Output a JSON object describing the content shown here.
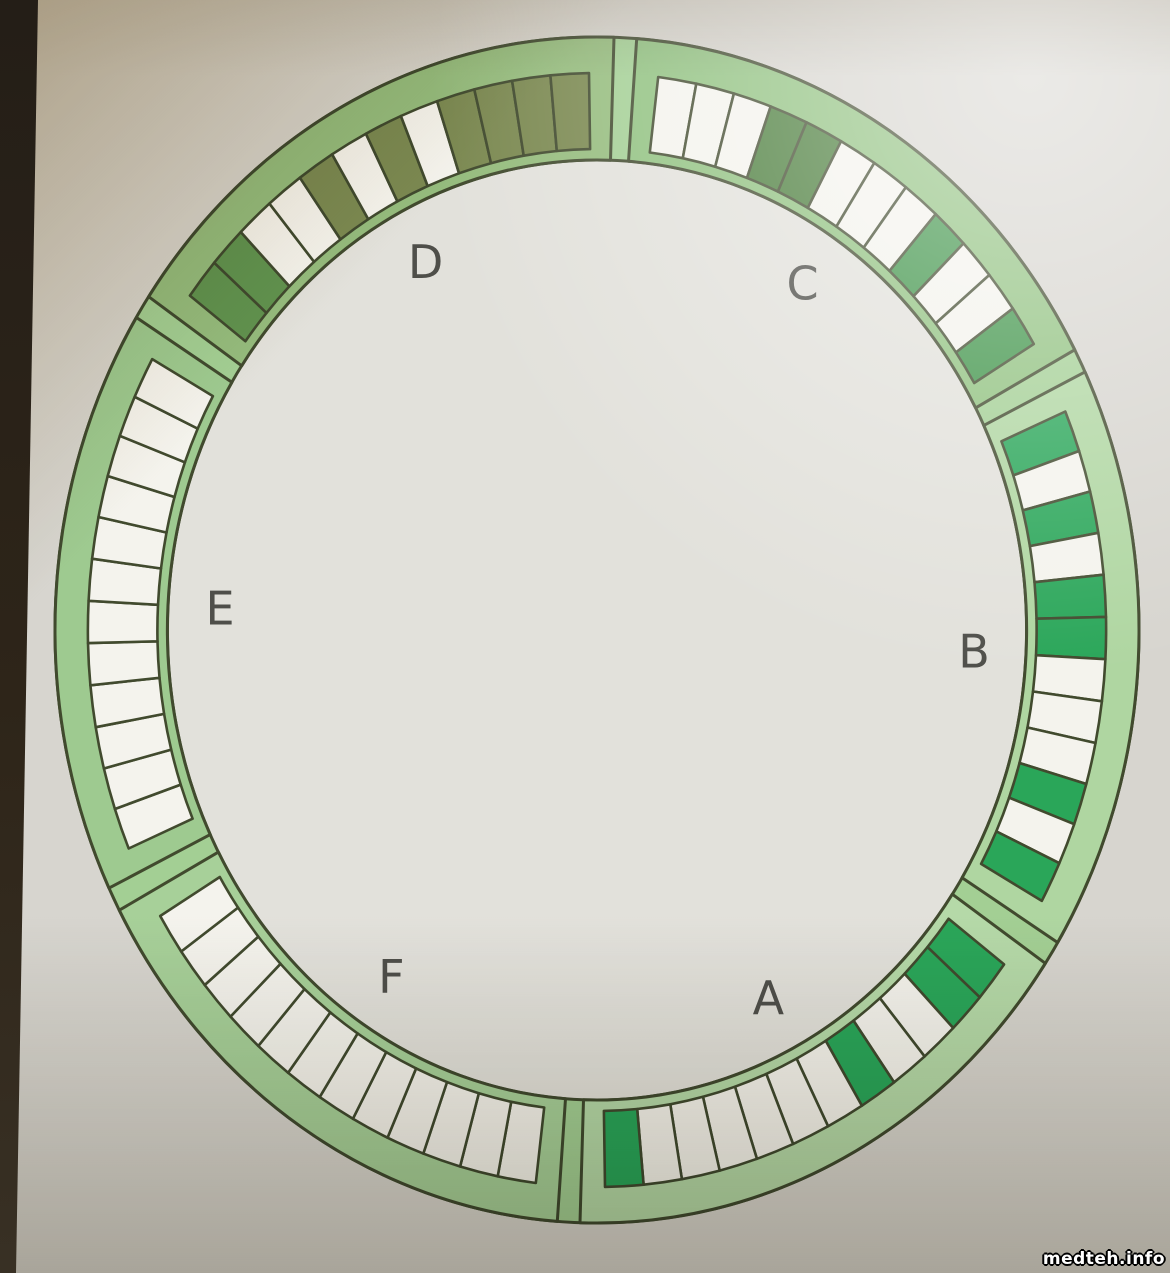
{
  "watermark": "medteh.info",
  "wheel": {
    "description_label": "sample-carousel-diagram",
    "stroke_color": "#414a2e",
    "label_color": "#4f4f4a",
    "base_ring_fill": "#a3cf94",
    "inner_disk_fill": "#e2e1db",
    "cell_states_palette": {
      "empty": "#f4f3ed",
      "green": "#2aa659",
      "green_mid": "#3f9449",
      "green_dark": "#4a7d3b",
      "olive": "#7b8951",
      "green_olive": "#61934f"
    },
    "sectors": [
      {
        "label": "A",
        "start_deg": -30,
        "ring_fill": "#b5d9a8",
        "cells": [
          "green",
          "green",
          "empty",
          "empty",
          "green",
          "empty",
          "empty",
          "empty",
          "empty",
          "empty",
          "empty",
          "green"
        ]
      },
      {
        "label": "B",
        "start_deg": 30,
        "ring_fill": "#afd6a1",
        "cells": [
          "green",
          "empty",
          "green",
          "empty",
          "green",
          "green",
          "empty",
          "empty",
          "empty",
          "green",
          "empty",
          "green"
        ]
      },
      {
        "label": "C",
        "start_deg": 90,
        "ring_fill": "#90c17f",
        "cells": [
          "empty",
          "empty",
          "empty",
          "green_dark",
          "green_dark",
          "empty",
          "empty",
          "empty",
          "green_mid",
          "empty",
          "empty",
          "green_mid"
        ]
      },
      {
        "label": "D",
        "start_deg": 150,
        "ring_fill": "#95bc7d",
        "cells": [
          "green_olive",
          "green_olive",
          "empty",
          "empty",
          "olive",
          "empty",
          "olive",
          "empty",
          "olive",
          "olive",
          "olive",
          "olive"
        ]
      },
      {
        "label": "E",
        "start_deg": 210,
        "ring_fill": "#9eca90",
        "cells": [
          "empty",
          "empty",
          "empty",
          "empty",
          "empty",
          "empty",
          "empty",
          "empty",
          "empty",
          "empty",
          "empty",
          "empty"
        ]
      },
      {
        "label": "F",
        "start_deg": 270,
        "ring_fill": "#a7d099",
        "cells": [
          "empty",
          "empty",
          "empty",
          "empty",
          "empty",
          "empty",
          "empty",
          "empty",
          "empty",
          "empty",
          "empty",
          "empty"
        ]
      }
    ]
  }
}
